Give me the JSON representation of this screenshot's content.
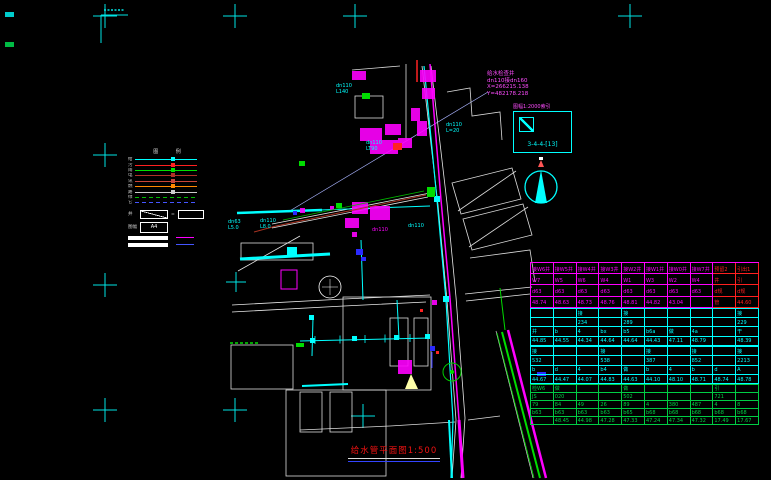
{
  "colors": {
    "background": "#000000",
    "water_cyan": "#00ffff",
    "sewer_magenta": "#ff00ff",
    "green_utility": "#00dd00",
    "red_accent": "#ff2020",
    "white_line": "#e8e8e8"
  },
  "ref_info": {
    "line1": "给水检查井",
    "line2": "dn110接dn160",
    "line3": "X=266215.138",
    "line4": "Y=482178.218"
  },
  "index_box": {
    "title": "图幅1:2000索引",
    "code": "3-4-4-[13]"
  },
  "sheet_title": {
    "text": "给水管平面图1:500"
  },
  "legend": {
    "header": "图 例",
    "rows": [
      {
        "label": "给",
        "color": "#00ffff",
        "dashed": false
      },
      {
        "label": "污",
        "color": "#ff2020",
        "dashed": false
      },
      {
        "label": "雨",
        "color": "#00e000",
        "dashed": false
      },
      {
        "label": "电",
        "color": "#b03028",
        "dashed": false
      },
      {
        "label": "讯",
        "color": "#c8453a",
        "dashed": false
      },
      {
        "label": "燃",
        "color": "#ff8800",
        "dashed": false
      },
      {
        "label": "路",
        "color": "#cccccc",
        "dashed": false
      },
      {
        "label": "绿",
        "color": "#00bb00",
        "dashed": true
      },
      {
        "label": "它",
        "color": "#4455ff",
        "dashed": true
      }
    ],
    "sample_label": "井",
    "sample_eq": "=",
    "frame_label": "图幅",
    "frame_value": "A4"
  },
  "map_labels": [
    {
      "text": "dn110\nL140",
      "x": 336,
      "y": 84,
      "color": "#00ffff"
    },
    {
      "text": "dn110\nL=20",
      "x": 446,
      "y": 123,
      "color": "#00ffff"
    },
    {
      "text": "dn110\nLT90",
      "x": 366,
      "y": 141,
      "color": "#00ffff"
    },
    {
      "text": "dn63\nL5.0",
      "x": 228,
      "y": 220,
      "color": "#00ffff"
    },
    {
      "text": "dn110\nL8.0",
      "x": 260,
      "y": 219,
      "color": "#00ffff"
    },
    {
      "text": "dn110",
      "x": 372,
      "y": 228,
      "color": "#ff00ff"
    },
    {
      "text": "dn110",
      "x": 408,
      "y": 224,
      "color": "#00ffff"
    }
  ],
  "table": {
    "groups": [
      {
        "color": "#ff00ff",
        "row_h": 10.2,
        "red_cols": true,
        "rows": [
          [
            "接W6井",
            "接W5井",
            "接W4井",
            "接W3井",
            "接W2井",
            "接W1井",
            "接W0井",
            "接W7井",
            "预留2",
            "引出1"
          ],
          [
            "W7",
            "W5",
            "W6",
            "W4",
            "W1",
            "W3",
            "W2",
            "W4",
            "井",
            "引"
          ],
          [
            "d63",
            "d63",
            "d63",
            "d63",
            "d63",
            "d63",
            "d63",
            "d63",
            "d规",
            "d规"
          ],
          [
            "48.74",
            "48.63",
            "48.73",
            "48.76",
            "48.81",
            "44.82",
            "43.04",
            "",
            "管",
            "44.60"
          ]
        ]
      },
      {
        "color": "#00ffff",
        "row_h": 8.3,
        "red_cols": false,
        "rows": [
          [
            "",
            "",
            "接",
            "",
            "接",
            "",
            "",
            "",
            "",
            "接"
          ],
          [
            "",
            "",
            "234",
            "",
            "289",
            "",
            "",
            "",
            "",
            "229"
          ],
          [
            "井",
            "b",
            "4",
            "bx",
            "b5",
            "b6a",
            "做",
            "4a",
            "",
            "干"
          ],
          [
            "44.85",
            "44.55",
            "44.34",
            "44.64",
            "44.64",
            "44.43",
            "47.11",
            "48.79",
            "",
            "48.39"
          ]
        ]
      },
      {
        "color": "#00ffff",
        "row_h": 8.3,
        "red_cols": false,
        "rows": [
          [
            "接",
            "",
            "",
            "接",
            "",
            "接",
            "",
            "接",
            "",
            "接"
          ],
          [
            "532",
            "",
            "",
            "538",
            "",
            "387",
            "",
            "852",
            "",
            "2213"
          ],
          [
            "b",
            "d",
            "4",
            "b4",
            "做",
            "b",
            "4",
            "b",
            "d",
            "A"
          ],
          [
            "44.67",
            "44.47",
            "44.07",
            "44.83",
            "44.63",
            "44.10",
            "48.10",
            "48.71",
            "48.74",
            "48.78"
          ]
        ]
      },
      {
        "color": "#00cc44",
        "row_h": 7,
        "red_cols": false,
        "rows": [
          [
            "检W6",
            "做",
            "",
            "",
            "做",
            "",
            "",
            "",
            "引",
            ""
          ],
          [
            "JS",
            "020",
            "",
            "",
            "502",
            "",
            "",
            "",
            "721",
            ""
          ],
          [
            "79",
            "84",
            "49",
            "26",
            "89",
            "4",
            "380",
            "487",
            "4",
            "8"
          ],
          [
            "b63",
            "b63",
            "b63",
            "b63",
            "b65",
            "b68",
            "b68",
            "b68",
            "b68",
            "b68"
          ],
          [
            "",
            "48.45",
            "44.98",
            "47.28",
            "47.33",
            "47.24",
            "47.34",
            "47.32",
            "17.49",
            "17.67"
          ]
        ]
      }
    ]
  }
}
